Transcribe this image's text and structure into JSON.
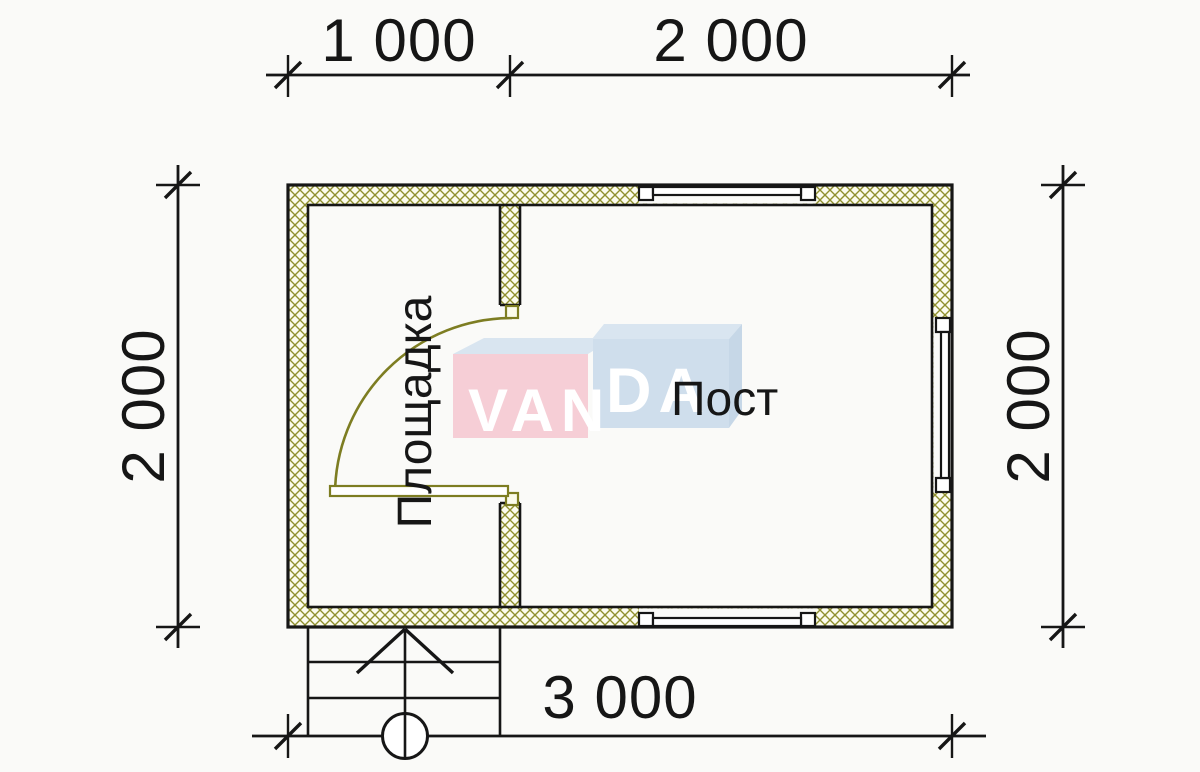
{
  "drawing": {
    "type": "floor-plan",
    "dimensions_mm": {
      "top_left_segment": "1 000",
      "top_right_segment": "2 000",
      "left_side": "2 000",
      "right_side": "2 000",
      "bottom_total": "3 000"
    },
    "rooms": [
      {
        "name": "Площадка"
      },
      {
        "name": "Пост"
      }
    ],
    "features": [
      "entry-stairs",
      "door-swing",
      "window-top",
      "window-bottom",
      "window-right"
    ]
  },
  "watermark": {
    "brand": "VANDA",
    "part1": "VAN",
    "part2": "DA"
  },
  "colors": {
    "bg": "#fafaf8",
    "line": "#161616",
    "hatch": "#90902f",
    "door": "#7d7d22",
    "logo-pink": "#f6ced6",
    "logo-blue": "#cfdeec",
    "logo-top": "#d9e5f0",
    "logo-side": "#c6d7e7"
  }
}
